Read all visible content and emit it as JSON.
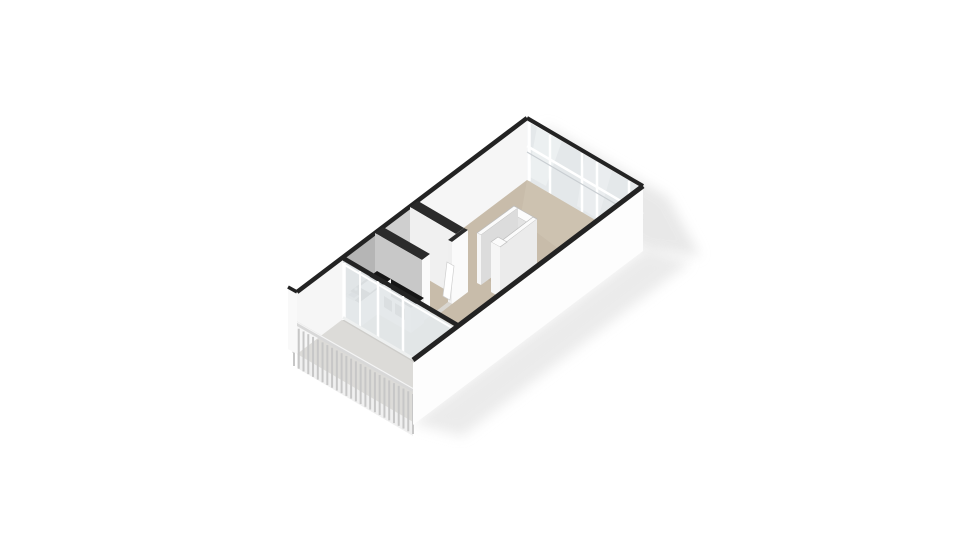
{
  "scene": {
    "type": "3d-floorplan-render",
    "view": "isometric-top",
    "elements": [
      "living-area",
      "kitchen",
      "bathroom",
      "wardrobe-column",
      "balcony",
      "window-wall",
      "railing"
    ]
  },
  "palette": {
    "background": "#ffffff",
    "shadow": "#e3e3e3",
    "wall_top": "#232323",
    "wall_top_partition": "#2b2b2b",
    "wall_interior": "#f6f6f6",
    "wall_exterior": "#fdfdfd",
    "wall_stub": "#f9f9f9",
    "bath_tile": "#cfcfcf",
    "kitchen_backsplash": "#b5b5b5",
    "glass": "#e4e8ea",
    "glass_highlight": "#f2f5f6",
    "frame": "#ffffff",
    "frame_rail2": "#c9ced2",
    "floor": "#c8bcaa",
    "floor_sheen": "#d2c7b6",
    "floor_inner": "#c2b6a4",
    "bath_floor": "#d9d6d1",
    "counter": "#161616",
    "cabinet": "#f3f3f3",
    "cabinet_shade": "#ececec",
    "appliance": "#3c3c3c",
    "sink": "#a7adb0",
    "sink_basin": "#565b5e",
    "faucet": "#9aa0a3",
    "column_top": "#fbfbfb",
    "column_edge": "#bcbcbc",
    "column_inner_a": "#e3e3e3",
    "column_inner_b": "#dcdcdc",
    "column_face_se": "#ebebeb",
    "column_face_sw": "#f6f6f6",
    "partition_lit": "#fafafa",
    "partition_sw": "#f0f0f0",
    "partition_gray": "#c8c8c8",
    "jamb": "#efefef",
    "door_leaf": "#ffffff",
    "door_edge": "#cfcfcf",
    "balcony_floor": "#dcdbd8",
    "balcony_edge_shadow": "#c6c5c2",
    "fascia": "#f0f0f0",
    "railing_slat": "#c7c7c7",
    "railing_top": "#d8d8d8",
    "railing_hi": "#f4f4f4",
    "railing_post": "#cfcfcf",
    "sill": "#eef0f0"
  },
  "railing": {
    "slat_count": 26,
    "slat_length": 40
  }
}
